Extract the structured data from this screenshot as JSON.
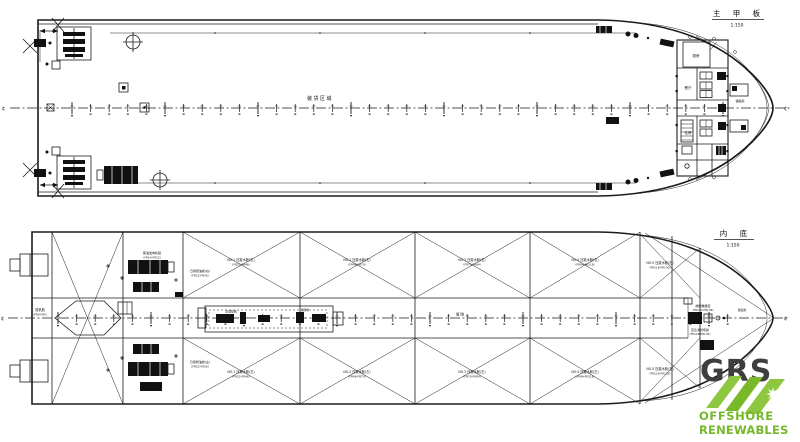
{
  "colors": {
    "ink": "#1b1b1b",
    "logo_green": "#8dc63f",
    "logo_text_green": "#76b82a",
    "logo_dark": "#3e3e3d"
  },
  "top_view": {
    "title": "主 甲 板",
    "scale": "1:150",
    "cl_left": "¢",
    "cl_right": "¢",
    "deck_area_label": "装货区域",
    "bow_cl_label": "锚链舱",
    "rooms": {
      "galley": "厨房",
      "mess": "餐厅",
      "cabin": "住房"
    }
  },
  "bottom_view": {
    "title": "内 底",
    "scale": "1:150",
    "cl_left": "¢",
    "cl_right": "¢",
    "stern": {
      "name": "舵机舱",
      "range": "(FR0-FR5)"
    },
    "tunnel": {
      "name": "管 隧",
      "pump1": "压载泵组",
      "pump2": "消防泵"
    },
    "machinery": {
      "gen_stbd": "柴油发电机组",
      "gen_stbd_range": "(FR14-FR22)",
      "fuel_stbd": "日用燃油舱(右)",
      "fuel_stbd_range": "(FR22-FR26)",
      "gen_port": "柴油发电机组",
      "gen_port_range": "(FR14-FR22)",
      "fuel_port": "日用燃油舱(左)",
      "fuel_port_range": "(FR22-FR26)"
    },
    "bow": {
      "thruster": "艏侧推器室",
      "thruster_range": "(FR132-FR136)",
      "pump_room": "应急消防泵舱",
      "pump_room_range": "(FR128-FR132)",
      "chain": "锚链舱"
    },
    "tanks_stbd": [
      {
        "name": "NO.1 压载水舱(右)",
        "range": "(FR22-FR46)"
      },
      {
        "name": "NO.2 压载水舱(右)",
        "range": "(FR46-FR70)"
      },
      {
        "name": "NO.3 压载水舱(右)",
        "range": "(FR70-FR94)"
      },
      {
        "name": "NO.4 压载水舱(右)",
        "range": "(FR94-FR118)"
      },
      {
        "name": "NO.5 压载水舱(右)",
        "range": "(FR118-FR130)"
      }
    ],
    "tanks_port": [
      {
        "name": "NO.1 压载水舱(左)",
        "range": "(FR22-FR46)"
      },
      {
        "name": "NO.2 压载水舱(左)",
        "range": "(FR46-FR70)"
      },
      {
        "name": "NO.3 压载水舱(左)",
        "range": "(FR70-FR94)"
      },
      {
        "name": "NO.4 压载水舱(左)",
        "range": "(FR94-FR118)"
      },
      {
        "name": "NO.5 压载水舱(左)",
        "range": "(FR118-FR130)"
      }
    ]
  },
  "logo": {
    "wordmark": "GRS",
    "line1": "OFFSHORE",
    "line2": "RENEWABLES"
  }
}
